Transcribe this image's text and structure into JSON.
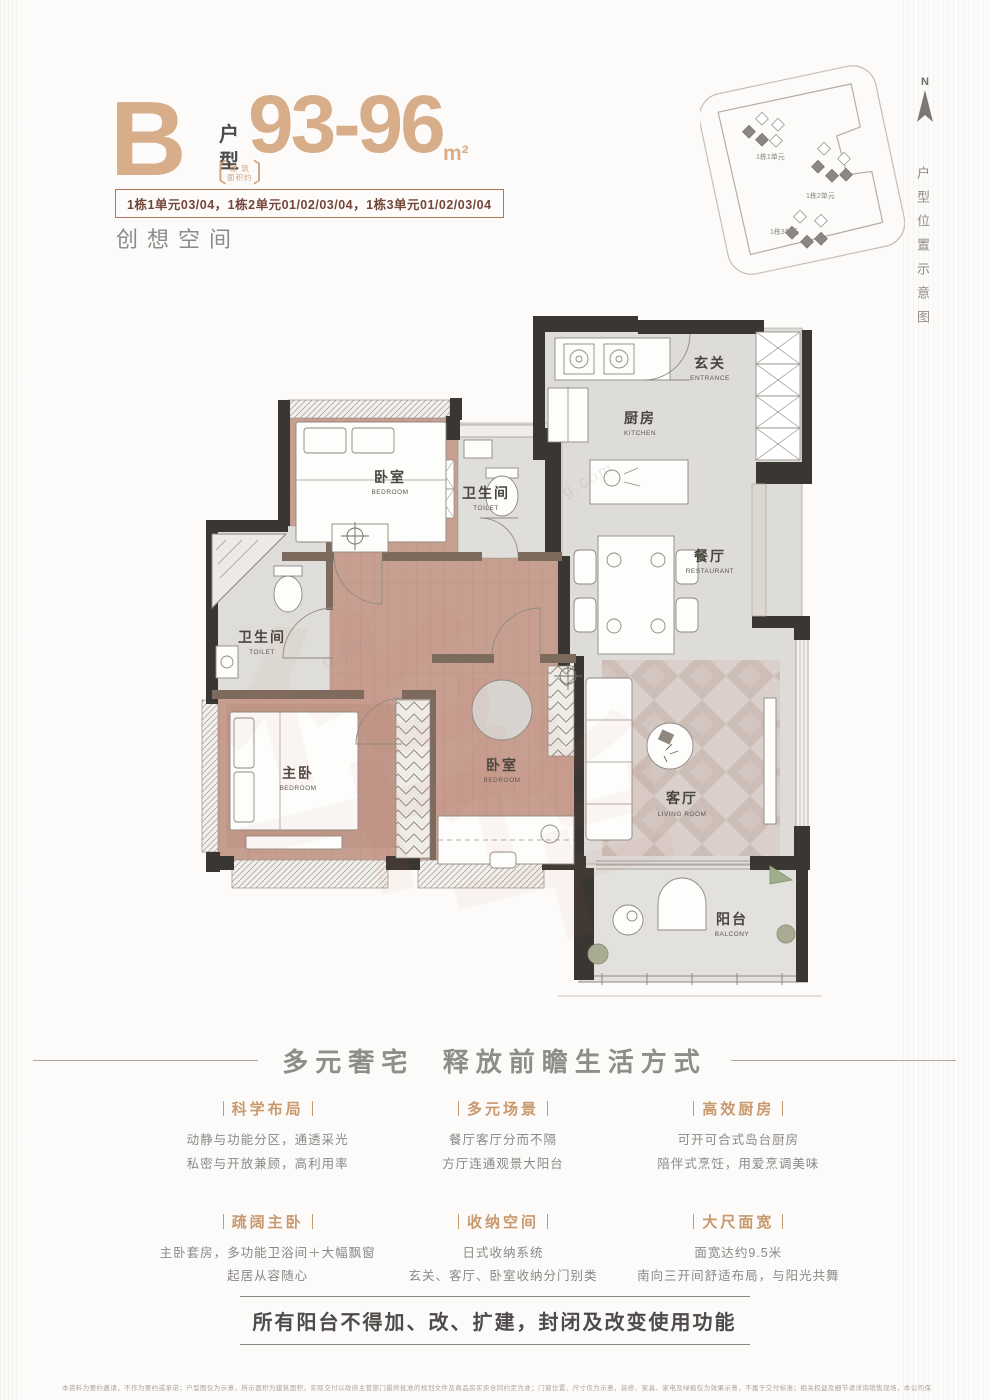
{
  "header": {
    "type_letter": "B",
    "type_char_1": "户",
    "type_char_2": "型",
    "area_note_l1": "建 筑",
    "area_note_l2": "面积约",
    "area_value": "93-96",
    "area_unit": "m²",
    "units_line": "1栋1单元03/04，1栋2单元01/02/03/04，1栋3单元01/02/03/04",
    "slogan": "创想空间",
    "accent_color": "#d8ae8a"
  },
  "siteplan": {
    "compass_label": "N",
    "side_caption": "户型位置示意图",
    "clusters": [
      {
        "label": "1栋1单元"
      },
      {
        "label": "1栋2单元"
      },
      {
        "label": "1栋3单元"
      }
    ]
  },
  "floorplan": {
    "rooms": [
      {
        "cn": "玄关",
        "en": "ENTRANCE"
      },
      {
        "cn": "厨房",
        "en": "KITCHEN"
      },
      {
        "cn": "卫生间",
        "en": "TOILET"
      },
      {
        "cn": "餐厅",
        "en": "RESTAURANT"
      },
      {
        "cn": "卧室",
        "en": "BEDROOM"
      },
      {
        "cn": "卫生间",
        "en": "TOILET"
      },
      {
        "cn": "主卧",
        "en": "BEDROOM"
      },
      {
        "cn": "卧室",
        "en": "BEDROOM"
      },
      {
        "cn": "客厅",
        "en": "LIVING ROOM"
      },
      {
        "cn": "阳台",
        "en": "BALCONY"
      }
    ],
    "wall_color": "#3a3632",
    "wood_color": "#c79f91",
    "floor_color": "#dedcd9"
  },
  "watermark": {
    "big_glyph": "华",
    "small_text": "g.com"
  },
  "features": {
    "heading": "多元奢宅  释放前瞻生活方式",
    "items": [
      {
        "title": "科学布局",
        "line1": "动静与功能分区，通透采光",
        "line2": "私密与开放兼顾，高利用率"
      },
      {
        "title": "多元场景",
        "line1": "餐厅客厅分而不隔",
        "line2": "方厅连通观景大阳台"
      },
      {
        "title": "高效厨房",
        "line1": "可开可合式岛台厨房",
        "line2": "陪伴式烹饪，用爱烹调美味"
      },
      {
        "title": "疏阔主卧",
        "line1": "主卧套房，多功能卫浴间＋大幅飘窗",
        "line2": "起居从容随心"
      },
      {
        "title": "收纳空间",
        "line1": "日式收纳系统",
        "line2": "玄关、客厅、卧室收纳分门别类"
      },
      {
        "title": "大尺面宽",
        "line1": "面宽达约9.5米",
        "line2": "南向三开间舒适布局，与阳光共舞"
      }
    ]
  },
  "notice": "所有阳台不得加、改、扩建，封闭及改变使用功能",
  "fine_print": "本资料为要约邀请，不作为要约或承诺；户型图仅为示意，所示面积为建筑面积，实际交付以政府主管部门最终批准的规划文件及商品房买卖合同约定为准；门窗位置、尺寸仅为示意，装修、家具、家电及绿植仅为效果示意，不属于交付标准；相关权益及细节请详询销售现场，本公司保留对宣传资料进行修改的权利，敬请留意最新资料。制作时间：2022年3月"
}
